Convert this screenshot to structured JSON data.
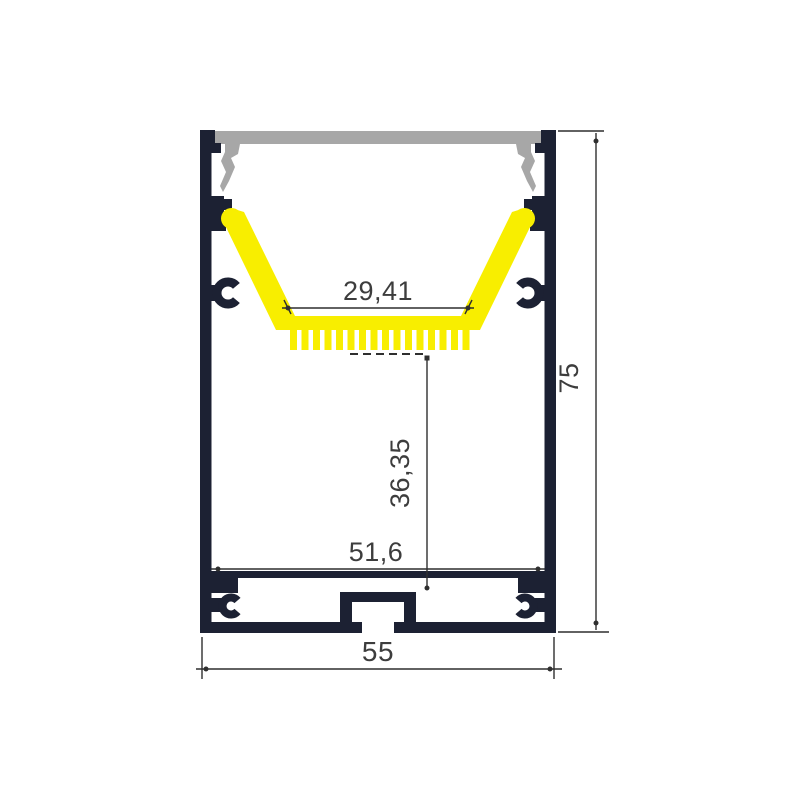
{
  "diagram": {
    "type": "technical-drawing",
    "background_color": "#ffffff",
    "colors": {
      "profile_body": "#1c2133",
      "led_tray": "#f8ee00",
      "diffuser": "#a7a7a7",
      "dimension_line": "#2f2f2f",
      "dimension_text": "#3d3d3d"
    },
    "dimensions": [
      {
        "id": "led-seat-width",
        "label": "29,41",
        "orientation": "horizontal"
      },
      {
        "id": "seat-to-base-depth",
        "label": "36,35",
        "orientation": "vertical"
      },
      {
        "id": "inner-width",
        "label": "51,6",
        "orientation": "horizontal"
      },
      {
        "id": "outer-width",
        "label": "55",
        "orientation": "horizontal"
      },
      {
        "id": "outer-height",
        "label": "75",
        "orientation": "vertical"
      }
    ]
  }
}
